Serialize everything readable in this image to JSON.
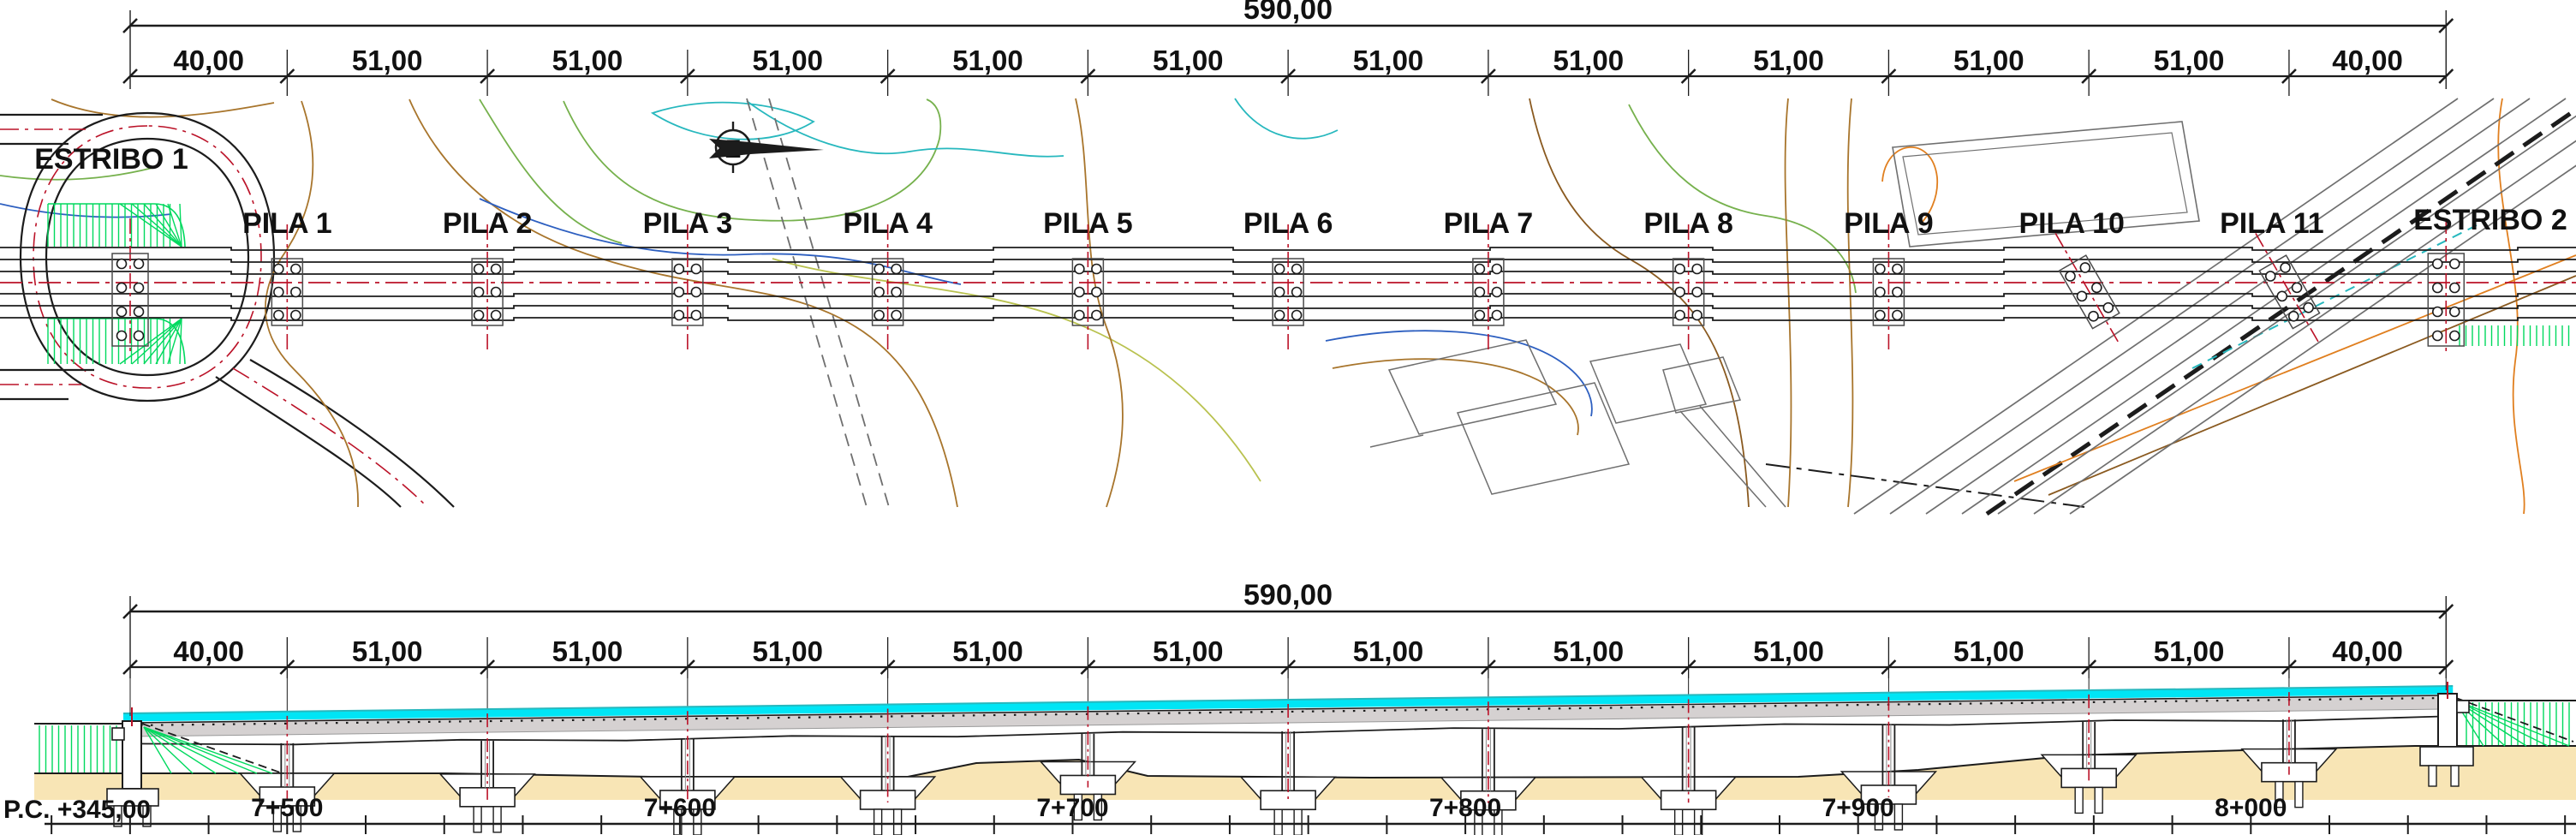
{
  "plan": {
    "total_dimension": "590,00",
    "span_dimensions": [
      "40,00",
      "51,00",
      "51,00",
      "51,00",
      "51,00",
      "51,00",
      "51,00",
      "51,00",
      "51,00",
      "51,00",
      "51,00",
      "40,00"
    ],
    "supports": [
      "ESTRIBO 1",
      "PILA 1",
      "PILA 2",
      "PILA 3",
      "PILA 4",
      "PILA 5",
      "PILA 6",
      "PILA 7",
      "PILA 8",
      "PILA 9",
      "PILA 10",
      "PILA 11",
      "ESTRIBO 2"
    ],
    "north_arrow": "north-arrow-icon"
  },
  "elevation": {
    "total_dimension": "590,00",
    "span_dimensions": [
      "40,00",
      "51,00",
      "51,00",
      "51,00",
      "51,00",
      "51,00",
      "51,00",
      "51,00",
      "51,00",
      "51,00",
      "51,00",
      "40,00"
    ],
    "datum": "P.C. +345,00",
    "chainages": [
      "7+500",
      "7+600",
      "7+700",
      "7+800",
      "7+900",
      "8+000"
    ]
  },
  "colors": {
    "line": "#1c1c1c",
    "centerline_red": "#bb1228",
    "hatch_green": "#00d95e",
    "contour_green": "#76b14d",
    "contour_yellow_green": "#b9c24f",
    "contour_brown": "#a8752c",
    "contour_dark_brown": "#8a5a20",
    "contour_orange": "#e07f1f",
    "stream_cyan": "#27b8be",
    "stream_blue": "#2d5fc0",
    "road_gray": "#6f6f6f",
    "deck_cyan": "#00e5f5",
    "deck_gray": "#d5d1d1",
    "ground_tan": "#f8e5b5"
  }
}
